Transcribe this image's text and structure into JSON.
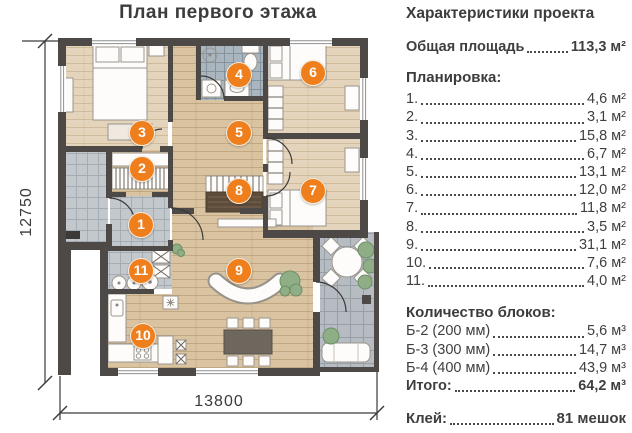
{
  "plan": {
    "title": "План первого этажа",
    "dim_left": "12750",
    "dim_bottom": "13800",
    "markers": [
      {
        "label": "1"
      },
      {
        "label": "2"
      },
      {
        "label": "3"
      },
      {
        "label": "4"
      },
      {
        "label": "5"
      },
      {
        "label": "6"
      },
      {
        "label": "7"
      },
      {
        "label": "8"
      },
      {
        "label": "9"
      },
      {
        "label": "10"
      },
      {
        "label": "11"
      }
    ]
  },
  "panel": {
    "title": "Характеристики проекта",
    "total_label": "Общая площадь",
    "total_value": "113,3 м²",
    "layout_title": "Планировка:",
    "rooms": [
      {
        "num": "1.",
        "area": "4,6 м²"
      },
      {
        "num": "2.",
        "area": "3,1 м²"
      },
      {
        "num": "3.",
        "area": "15,8 м²"
      },
      {
        "num": "4.",
        "area": "6,7 м²"
      },
      {
        "num": "5.",
        "area": "13,1 м²"
      },
      {
        "num": "6.",
        "area": "12,0 м²"
      },
      {
        "num": "7.",
        "area": "11,8 м²"
      },
      {
        "num": "8.",
        "area": "3,5 м²"
      },
      {
        "num": "9.",
        "area": "31,1 м²"
      },
      {
        "num": "10.",
        "area": "7,6 м²"
      },
      {
        "num": "11.",
        "area": "4,0 м²"
      }
    ],
    "blocks_title": "Количество блоков:",
    "blocks": [
      {
        "label": "Б-2 (200 мм)",
        "value": "5,6 м³"
      },
      {
        "label": "Б-3 (300 мм)",
        "value": "14,7 м³"
      },
      {
        "label": "Б-4 (400 мм)",
        "value": "43,9 м³"
      }
    ],
    "blocks_total_label": "Итого:",
    "blocks_total_value": "64,2 м³",
    "glue_label": "Клей:",
    "glue_value": "81 мешок"
  },
  "colors": {
    "marker_orange": "#EF7F1D",
    "wall_dark": "#4C4946",
    "wood_floor": "#DCC6A4",
    "tile_grey": "#BEC4C9",
    "text": "#3F3F3F"
  }
}
